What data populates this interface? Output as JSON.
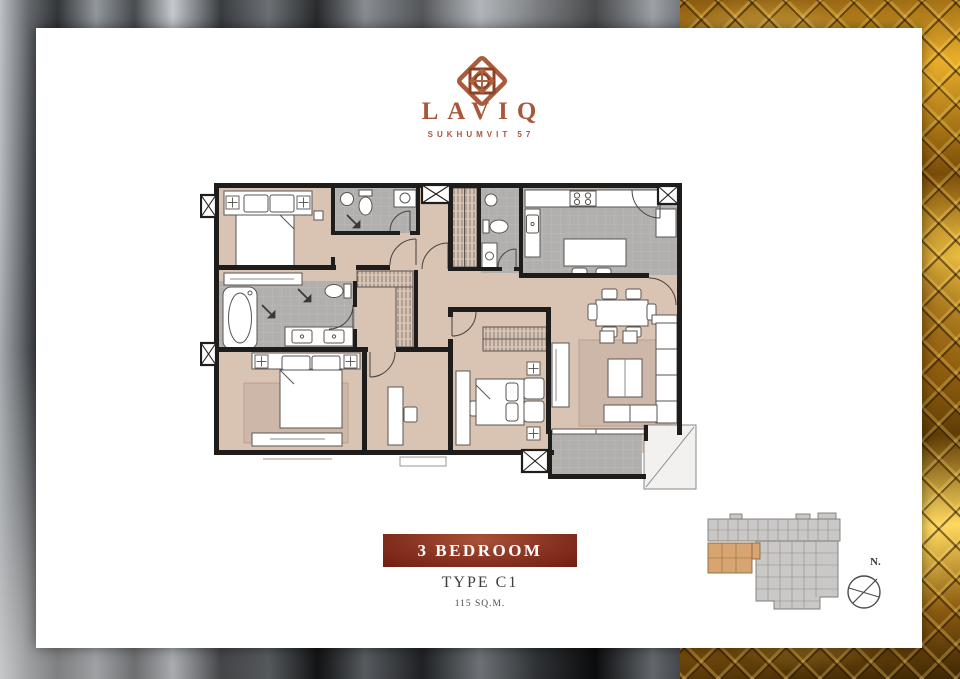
{
  "brand": {
    "name": "LAVIQ",
    "tagline": "SUKHUMVIT 57"
  },
  "plan_info": {
    "banner": "3 BEDROOM",
    "type": "TYPE C1",
    "area": "115 SQ.M."
  },
  "keyplan": {
    "north": "N."
  },
  "icons": {
    "logo": "laviq-knot-icon",
    "compass": "compass-icon"
  },
  "palette": {
    "brand_copper": "#a9573b",
    "banner_maroon_dark": "#6f1f11",
    "banner_maroon_light": "#a85338",
    "floor_tan": "#d9c3b3",
    "rug_tan": "#cdb7a8",
    "wet_area_gray": "#b2b0ae",
    "wall_black": "#1f1d1b",
    "keyplan_gray": "#c9c8c6",
    "keyplan_highlight": "#d8a570",
    "gold": "#e8ae2a",
    "satin_gray": "#5a5e63"
  }
}
